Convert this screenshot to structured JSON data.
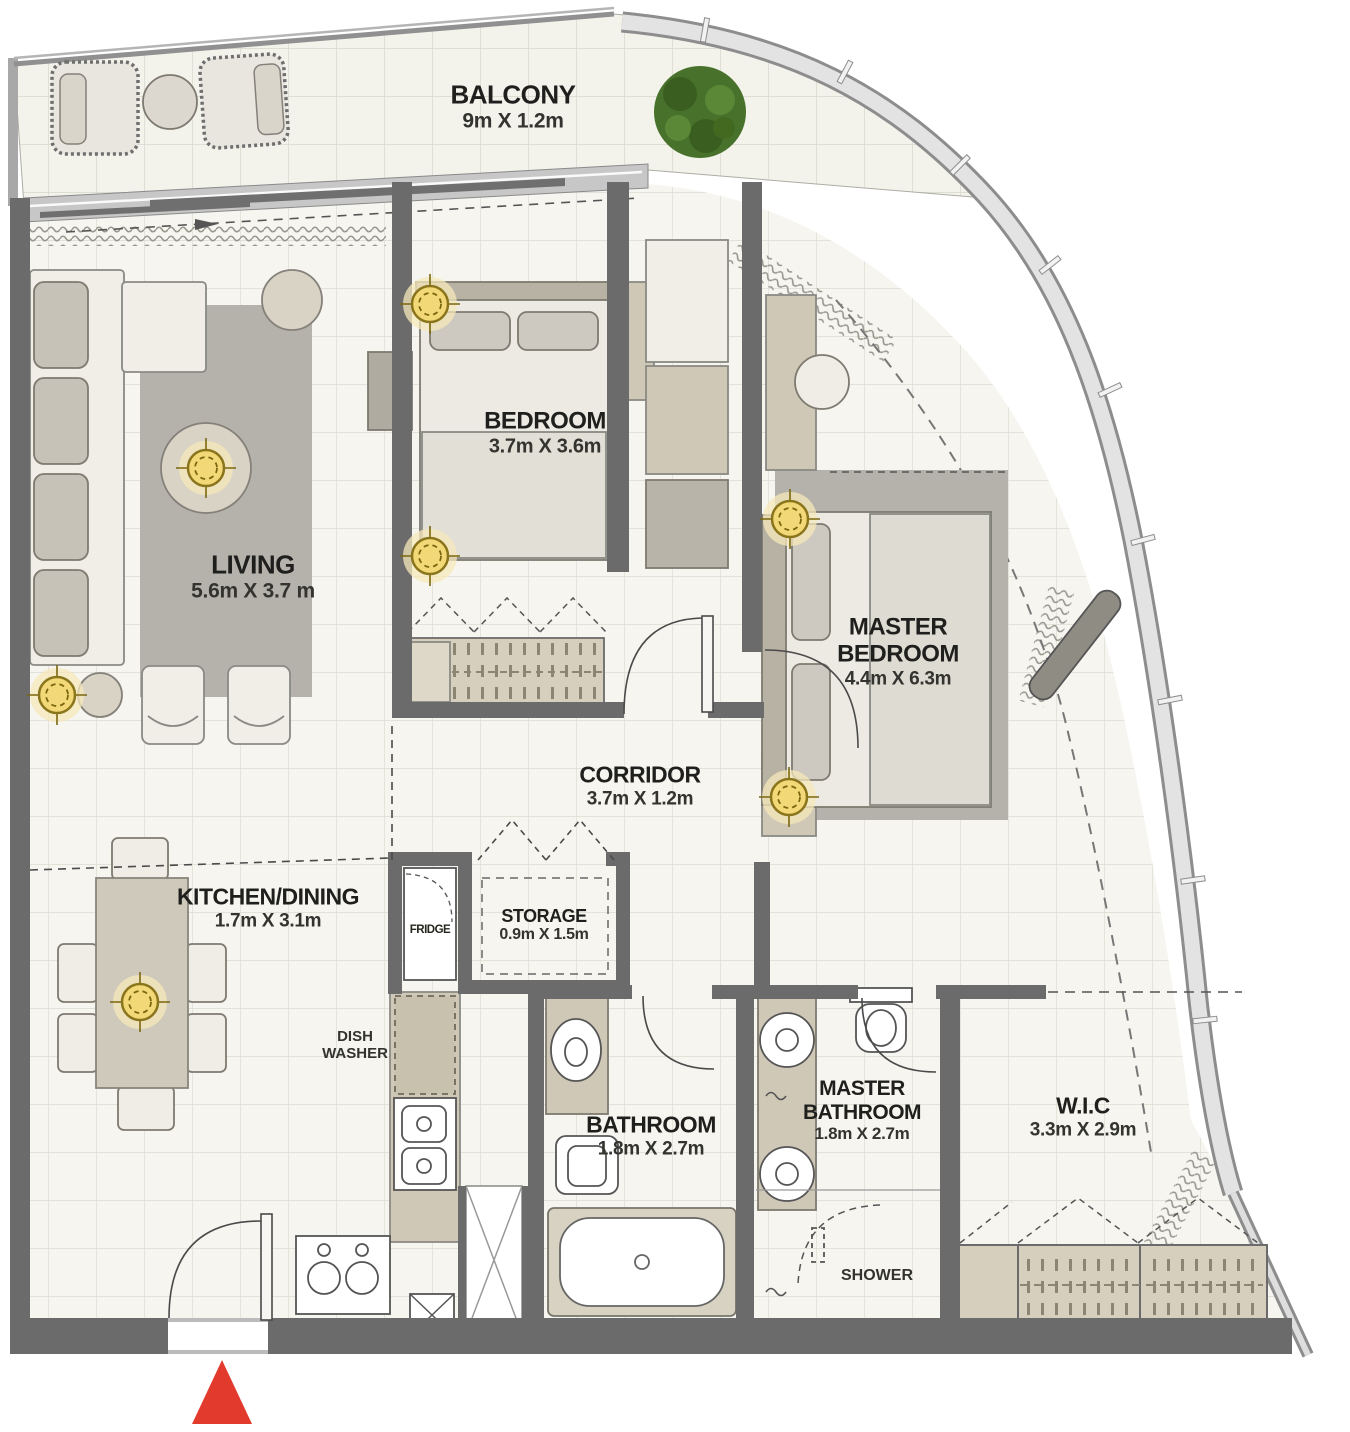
{
  "plan_title": "3-bedroom apartment floor plan",
  "rooms": {
    "balcony": {
      "label": "BALCONY",
      "dims": "9m X 1.2m"
    },
    "bedroom": {
      "label": "BEDROOM",
      "dims": "3.7m X 3.6m"
    },
    "living": {
      "label": "LIVING",
      "dims": "5.6m X 3.7 m"
    },
    "master_bedroom": {
      "label_line1": "MASTER",
      "label_line2": "BEDROOM",
      "dims": "4.4m X 6.3m"
    },
    "corridor": {
      "label": "CORRIDOR",
      "dims": "3.7m X 1.2m"
    },
    "kitchen": {
      "label": "KITCHEN/DINING",
      "dims": "1.7m X 3.1m"
    },
    "storage": {
      "label": "STORAGE",
      "dims": "0.9m X 1.5m"
    },
    "bathroom": {
      "label": "BATHROOM",
      "dims": "1.8m X 2.7m"
    },
    "master_bathroom": {
      "label_line1": "MASTER",
      "label_line2": "BATHROOM",
      "dims": "1.8m X 2.7m"
    },
    "wic": {
      "label": "W.I.C",
      "dims": "3.3m X 2.9m"
    }
  },
  "fixtures": {
    "fridge": "FRIDGE",
    "dish_washer_line1": "DISH",
    "dish_washer_line2": "WASHER",
    "shower": "SHOWER"
  },
  "colors": {
    "wall": "#6b6b6b",
    "floor": "#f6f5ef",
    "grid_line": "#dddcd2",
    "furniture_beige": "#cfc8b6",
    "furniture_light": "#f0eee7",
    "rug_gray": "#b5b2ab",
    "light_fixture_yellow": "#f3d878",
    "entrance_marker_red": "#e23b2e",
    "plant_green": "#48722b"
  }
}
